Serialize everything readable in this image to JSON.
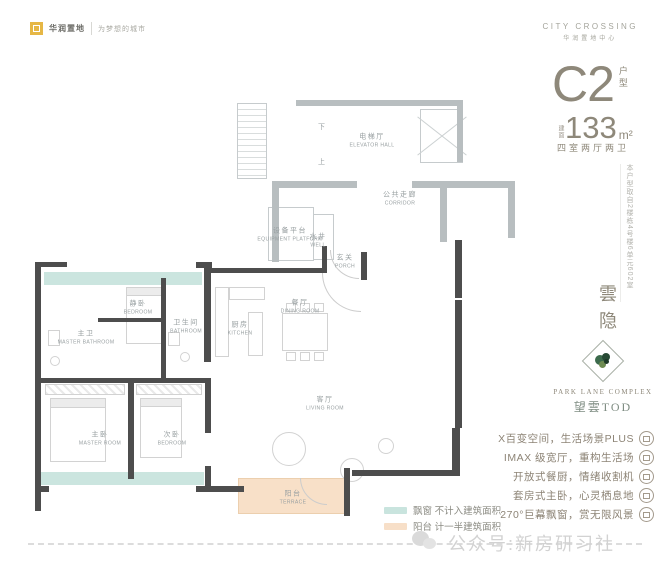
{
  "header": {
    "brand_name": "华润置地",
    "brand_divider": "|",
    "brand_slogan": "为梦想的城市",
    "brand_color": "#e6b745",
    "project_line1": "CITY CROSSING",
    "project_line2": "华润置地中心"
  },
  "unit_panel": {
    "model": "C2",
    "model_suffix": "户型",
    "area_prefix": "建面",
    "area_number": "133",
    "area_unit": "m²",
    "layout": "四室两厅两卫",
    "source_note": "本户型取自2楼栋4号楼6单元602室",
    "unit_name": "雲隐"
  },
  "park_logo": {
    "title": "PARK LANE COMPLEX",
    "subtitle": "望雲TOD",
    "flower_color": "#3c6a4c"
  },
  "features": [
    {
      "text": "X百变空间，生活场景PLUS"
    },
    {
      "text": "IMAX 级宽厅，重构生活场"
    },
    {
      "text": "开放式餐厨，情绪收割机"
    },
    {
      "text": "套房式主卧，心灵栖息地"
    },
    {
      "text": "270°巨幕飘窗，赏无限风景"
    }
  ],
  "legend": [
    {
      "swatch": "#c9e4de",
      "label": "飘窗 不计入建筑面积"
    },
    {
      "swatch": "#f7dfc8",
      "label": "阳台 计一半建筑面积"
    }
  ],
  "floorplan": {
    "stair_down": "下",
    "stair_up": "上",
    "colors": {
      "wall_dark": "#4d4d4d",
      "wall_light": "#b8bec0",
      "bay_window": "#cbe5df",
      "terrace": "#f8e0c8"
    },
    "rooms": [
      {
        "zh": "电梯厅",
        "en": "ELEVATOR HALL"
      },
      {
        "zh": "公共走廊",
        "en": "CORRIDOR"
      },
      {
        "zh": "水井",
        "en": "WELL"
      },
      {
        "zh": "设备平台",
        "en": "EQUIPMENT PLATFORM"
      },
      {
        "zh": "玄关",
        "en": "PORCH"
      },
      {
        "zh": "静卧",
        "en": "BEDROOM"
      },
      {
        "zh": "主卫",
        "en": "MASTER BATHROOM"
      },
      {
        "zh": "卫生间",
        "en": "BATHROOM"
      },
      {
        "zh": "厨房",
        "en": "KITCHEN"
      },
      {
        "zh": "餐厅",
        "en": "DINING ROOM"
      },
      {
        "zh": "客厅",
        "en": "LIVING ROOM"
      },
      {
        "zh": "主卧",
        "en": "MASTER ROOM"
      },
      {
        "zh": "次卧",
        "en": "BEDROOM"
      },
      {
        "zh": "阳台",
        "en": "TERRACE"
      }
    ]
  },
  "watermark": {
    "text": "公众号:新房研习社"
  }
}
